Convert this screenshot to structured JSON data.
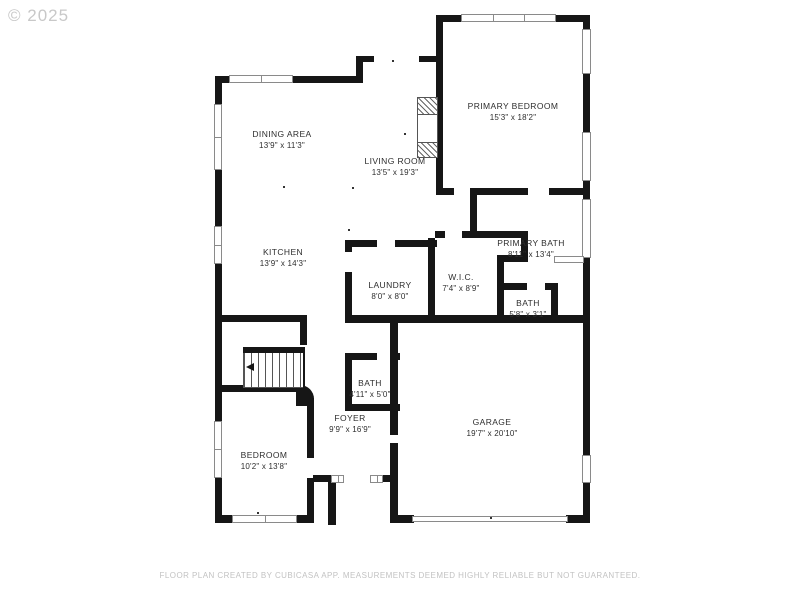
{
  "watermark": "© 2025",
  "footer": "FLOOR PLAN CREATED BY CUBICASA APP. MEASUREMENTS DEEMED HIGHLY RELIABLE BUT NOT GUARANTEED.",
  "rooms": {
    "dining": {
      "name": "DINING AREA",
      "dims": "13'9\" x 11'3\""
    },
    "primary_bedroom": {
      "name": "PRIMARY BEDROOM",
      "dims": "15'3\" x 18'2\""
    },
    "living": {
      "name": "LIVING ROOM",
      "dims": "13'5\" x 19'3\""
    },
    "kitchen": {
      "name": "KITCHEN",
      "dims": "13'9\" x 14'3\""
    },
    "primary_bath": {
      "name": "PRIMARY BATH",
      "dims": "8'11\" x 13'4\""
    },
    "laundry": {
      "name": "LAUNDRY",
      "dims": "8'0\" x 8'0\""
    },
    "wic": {
      "name": "W.I.C.",
      "dims": "7'4\" x 8'9\""
    },
    "bath_upper": {
      "name": "BATH",
      "dims": "5'8\" x 3'1\""
    },
    "bath_lower": {
      "name": "BATH",
      "dims": "4'11\" x 5'0\""
    },
    "foyer": {
      "name": "FOYER",
      "dims": "9'9\" x 16'9\""
    },
    "bedroom": {
      "name": "BEDROOM",
      "dims": "10'2\" x 13'8\""
    },
    "garage": {
      "name": "GARAGE",
      "dims": "19'7\" x 20'10\""
    }
  },
  "colors": {
    "wall": "#161616",
    "label": "#2e2e2e",
    "muted": "#c8c8c8"
  }
}
